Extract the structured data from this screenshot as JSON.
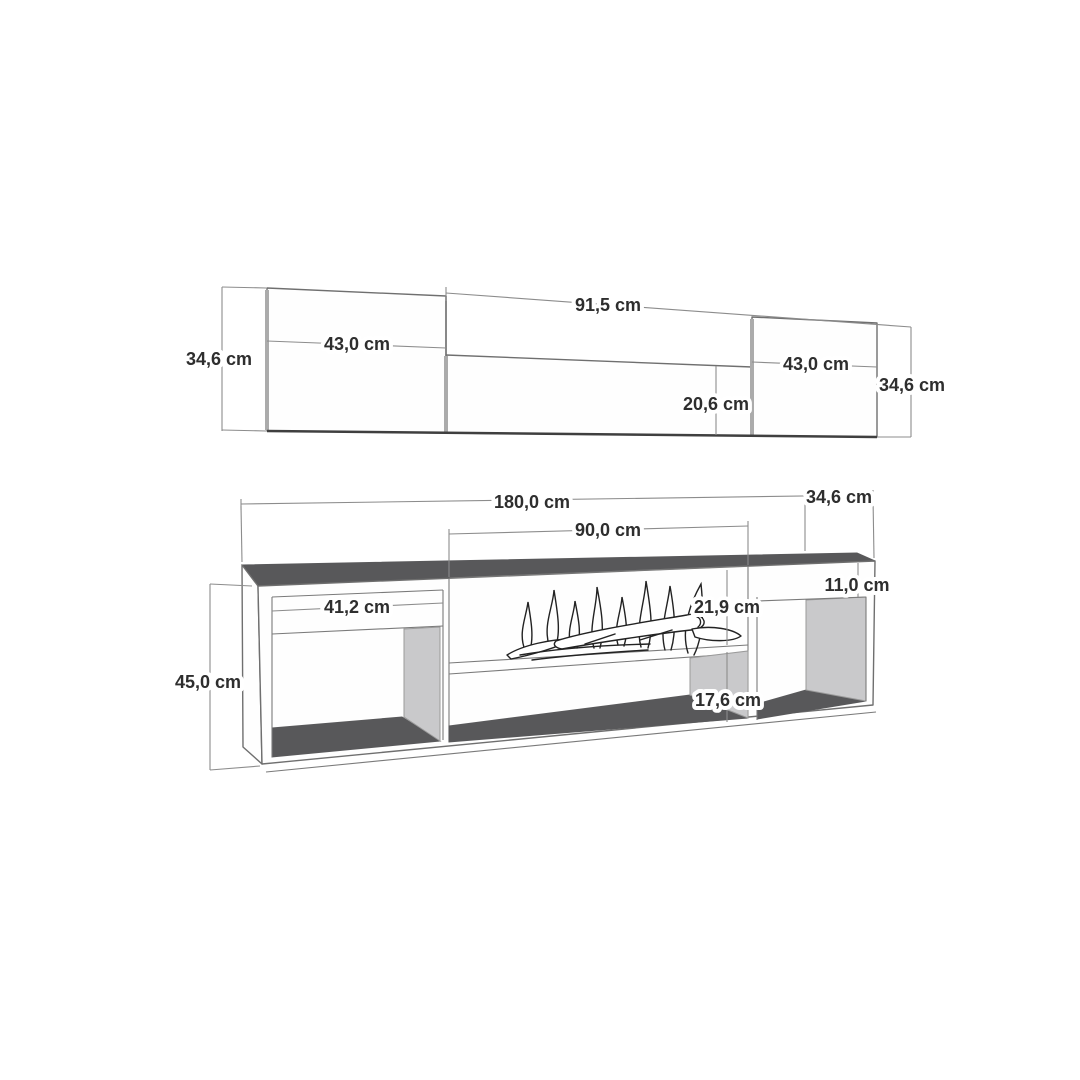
{
  "front_view": {
    "labels": {
      "height_left": "34,6 cm",
      "door_left_width": "43,0 cm",
      "middle_width": "91,5 cm",
      "middle_panel_height": "20,6 cm",
      "door_right_width": "43,0 cm",
      "height_right": "34,6 cm"
    }
  },
  "perspective_view": {
    "labels": {
      "total_width": "180,0 cm",
      "depth": "34,6 cm",
      "fireplace_width": "90,0 cm",
      "top_shelf_height": "11,0 cm",
      "left_compartment_width": "41,2 cm",
      "fireplace_height": "21,9 cm",
      "total_height": "45,0 cm",
      "bottom_shelf_height": "17,6 cm"
    }
  },
  "colors": {
    "background": "#ffffff",
    "surface_dark": "#58585a",
    "surface_light": "#c9c9cb",
    "line": "#6f6f6f",
    "dimension_line": "#8c8c8c",
    "text": "#2e2e2e"
  }
}
